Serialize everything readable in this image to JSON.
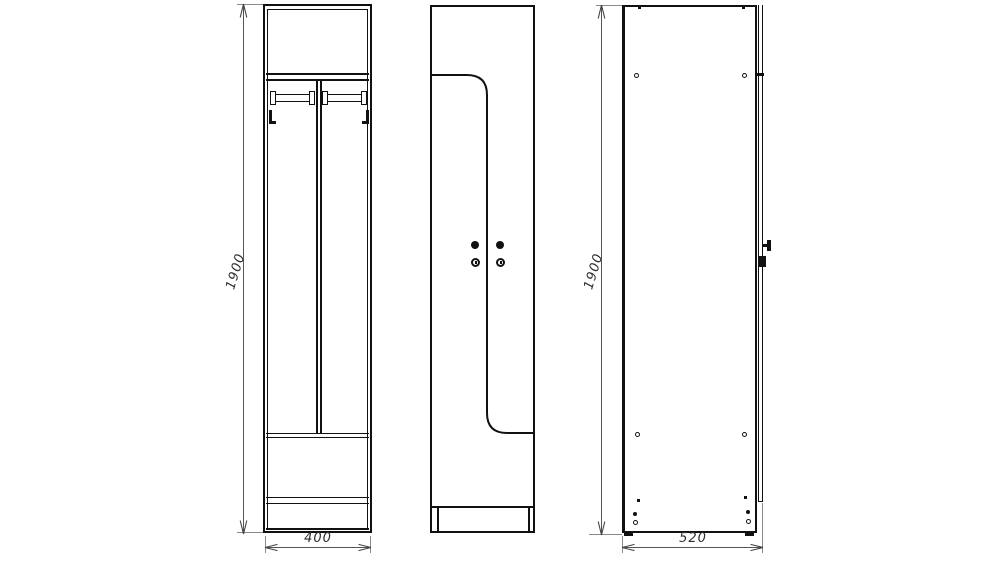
{
  "dimensions": {
    "front_height": "1900",
    "front_width": "400",
    "side_height": "1900",
    "side_depth": "520"
  },
  "colors": {
    "background": "#ffffff",
    "drawing_line": "#111111",
    "dimension_line": "#555555",
    "extension_line": "#8a8a8a",
    "label_text": "#2e2e2e"
  },
  "icons": {
    "dim_arrow_up": "thin open CAD arrowhead pointing up",
    "dim_arrow_down": "thin open CAD arrowhead pointing down",
    "dim_arrow_left": "thin open CAD arrowhead pointing left",
    "dim_arrow_right": "thin open CAD arrowhead pointing right"
  }
}
